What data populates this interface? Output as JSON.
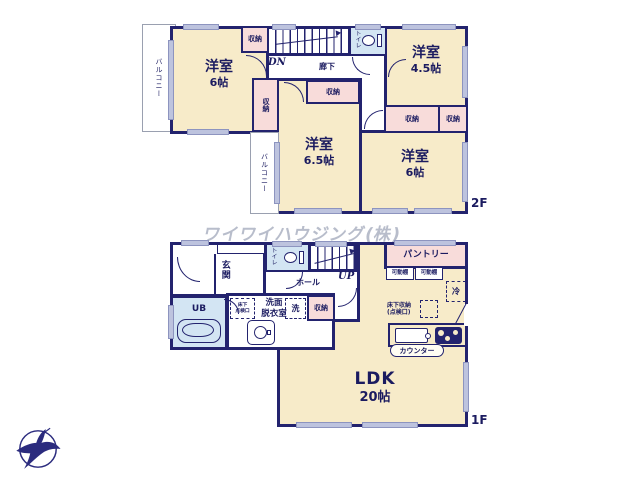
{
  "watermark": "ワイワイハウジング(株)",
  "colors": {
    "wall": "#23236e",
    "room_fill": "#f7ebc9",
    "closet_fill": "#f8dcda",
    "wet_fill": "#d3e5f3",
    "window_fill": "#bdc3de",
    "label_text": "#1b1b60"
  },
  "floor2": {
    "label": "2F",
    "balcony_left": "バルコニー",
    "balcony_center": "バルコニー",
    "room_nw_name": "洋室",
    "room_nw_size": "6帖",
    "room_ne_name": "洋室",
    "room_ne_size": "4.5帖",
    "room_center_name": "洋室",
    "room_center_size": "6.5帖",
    "room_se_name": "洋室",
    "room_se_size": "6帖",
    "hallway": "廊下",
    "stairs_down": "DN",
    "toilet": "トイレ",
    "closet_a": "収納",
    "closet_b": "収納",
    "closet_c": "収納",
    "closet_d": "収納",
    "closet_e": "収納"
  },
  "floor1": {
    "label": "1F",
    "entrance": "玄関",
    "hall": "ホール",
    "stairs_up": "UP",
    "toilet": "トイレ",
    "pantry": "パントリー",
    "shelf_left": "可動棚",
    "shelf_right": "可動棚",
    "fridge": "冷",
    "bath": "UB",
    "hatch_line1": "床下",
    "hatch_line2": "点検口",
    "washroom_line1": "洗面",
    "washroom_line2": "脱衣室",
    "washer": "洗",
    "closet": "収納",
    "underfloor_line1": "床下収納",
    "underfloor_line2": "(点検口)",
    "counter": "カウンター",
    "ldk_name": "LDK",
    "ldk_size": "20帖"
  }
}
